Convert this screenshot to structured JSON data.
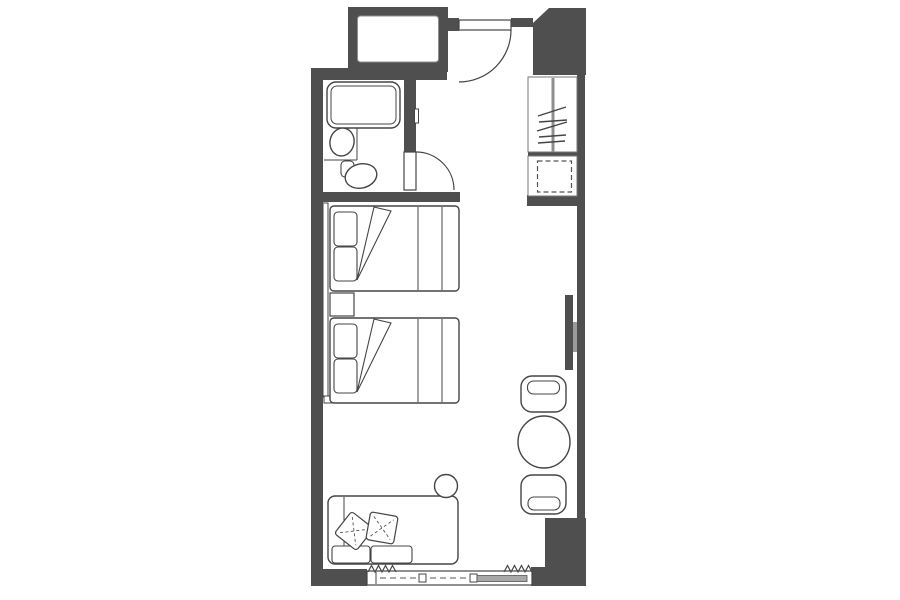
{
  "canvas": {
    "width": 900,
    "height": 600,
    "background": "#ffffff"
  },
  "palette": {
    "wall": "#4f4f4f",
    "outline": "#454545",
    "hanger_rod": "#8f8f8f",
    "tv_bracket": "#9a9a9a",
    "window_glass_panel": "#a8a8a8",
    "floor": "#ffffff"
  },
  "plan": {
    "description": "architectural floor plan of a hotel guest room, no text labels",
    "elements": [
      "duct-shaft",
      "entry-door-with-swing",
      "wardrobe-with-hanging-rod-and-hangers",
      "luggage-rack",
      "bathroom",
      "bathtub",
      "washbasin",
      "toilet",
      "bathroom-door-with-swing",
      "headboard-panel",
      "twin-bed-1",
      "twin-bed-2",
      "nightstand",
      "wall-mounted-tv",
      "sofa-with-cushions",
      "throw-pillow-1",
      "throw-pillow-2",
      "round-side-stool",
      "round-table",
      "chair-top",
      "chair-bottom",
      "sliding-window",
      "curtain-left",
      "curtain-right"
    ]
  }
}
